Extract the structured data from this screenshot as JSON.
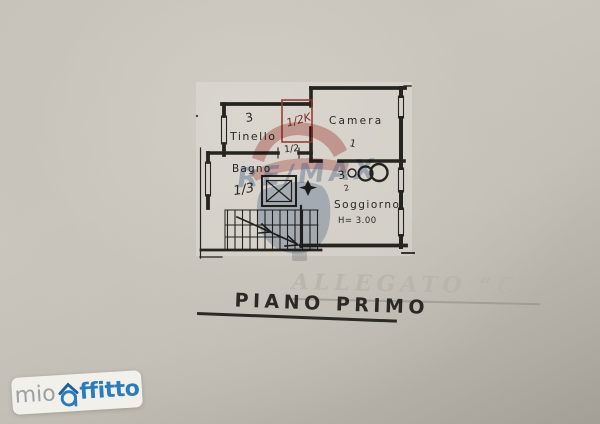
{
  "document": {
    "floor_title": "PIANO PRIMO",
    "allegato_watermark": "ALLEGATO “C”"
  },
  "plan": {
    "rooms": {
      "tinello": {
        "label": "Tinello",
        "note": "3"
      },
      "camera": {
        "label": "Camera",
        "note": "1"
      },
      "bagno": {
        "label": "Bagno",
        "fraction": "1/3"
      },
      "soggiorno": {
        "label": "Soggiorno",
        "height": "H= 3.00",
        "measure_digit": "3",
        "measure_sub": "2"
      }
    },
    "annotations": {
      "red_door_note": "1/2K",
      "corridor_fraction": "1/2"
    }
  },
  "watermarks": {
    "remax": {
      "text": "RE/MAX",
      "red": "#c4625c",
      "blue": "#8aa0c2"
    },
    "mioaffitto": {
      "prefix": "mio",
      "suffix": "ffitto",
      "blue": "#2b7cba",
      "gray": "#9aa0a4"
    }
  }
}
